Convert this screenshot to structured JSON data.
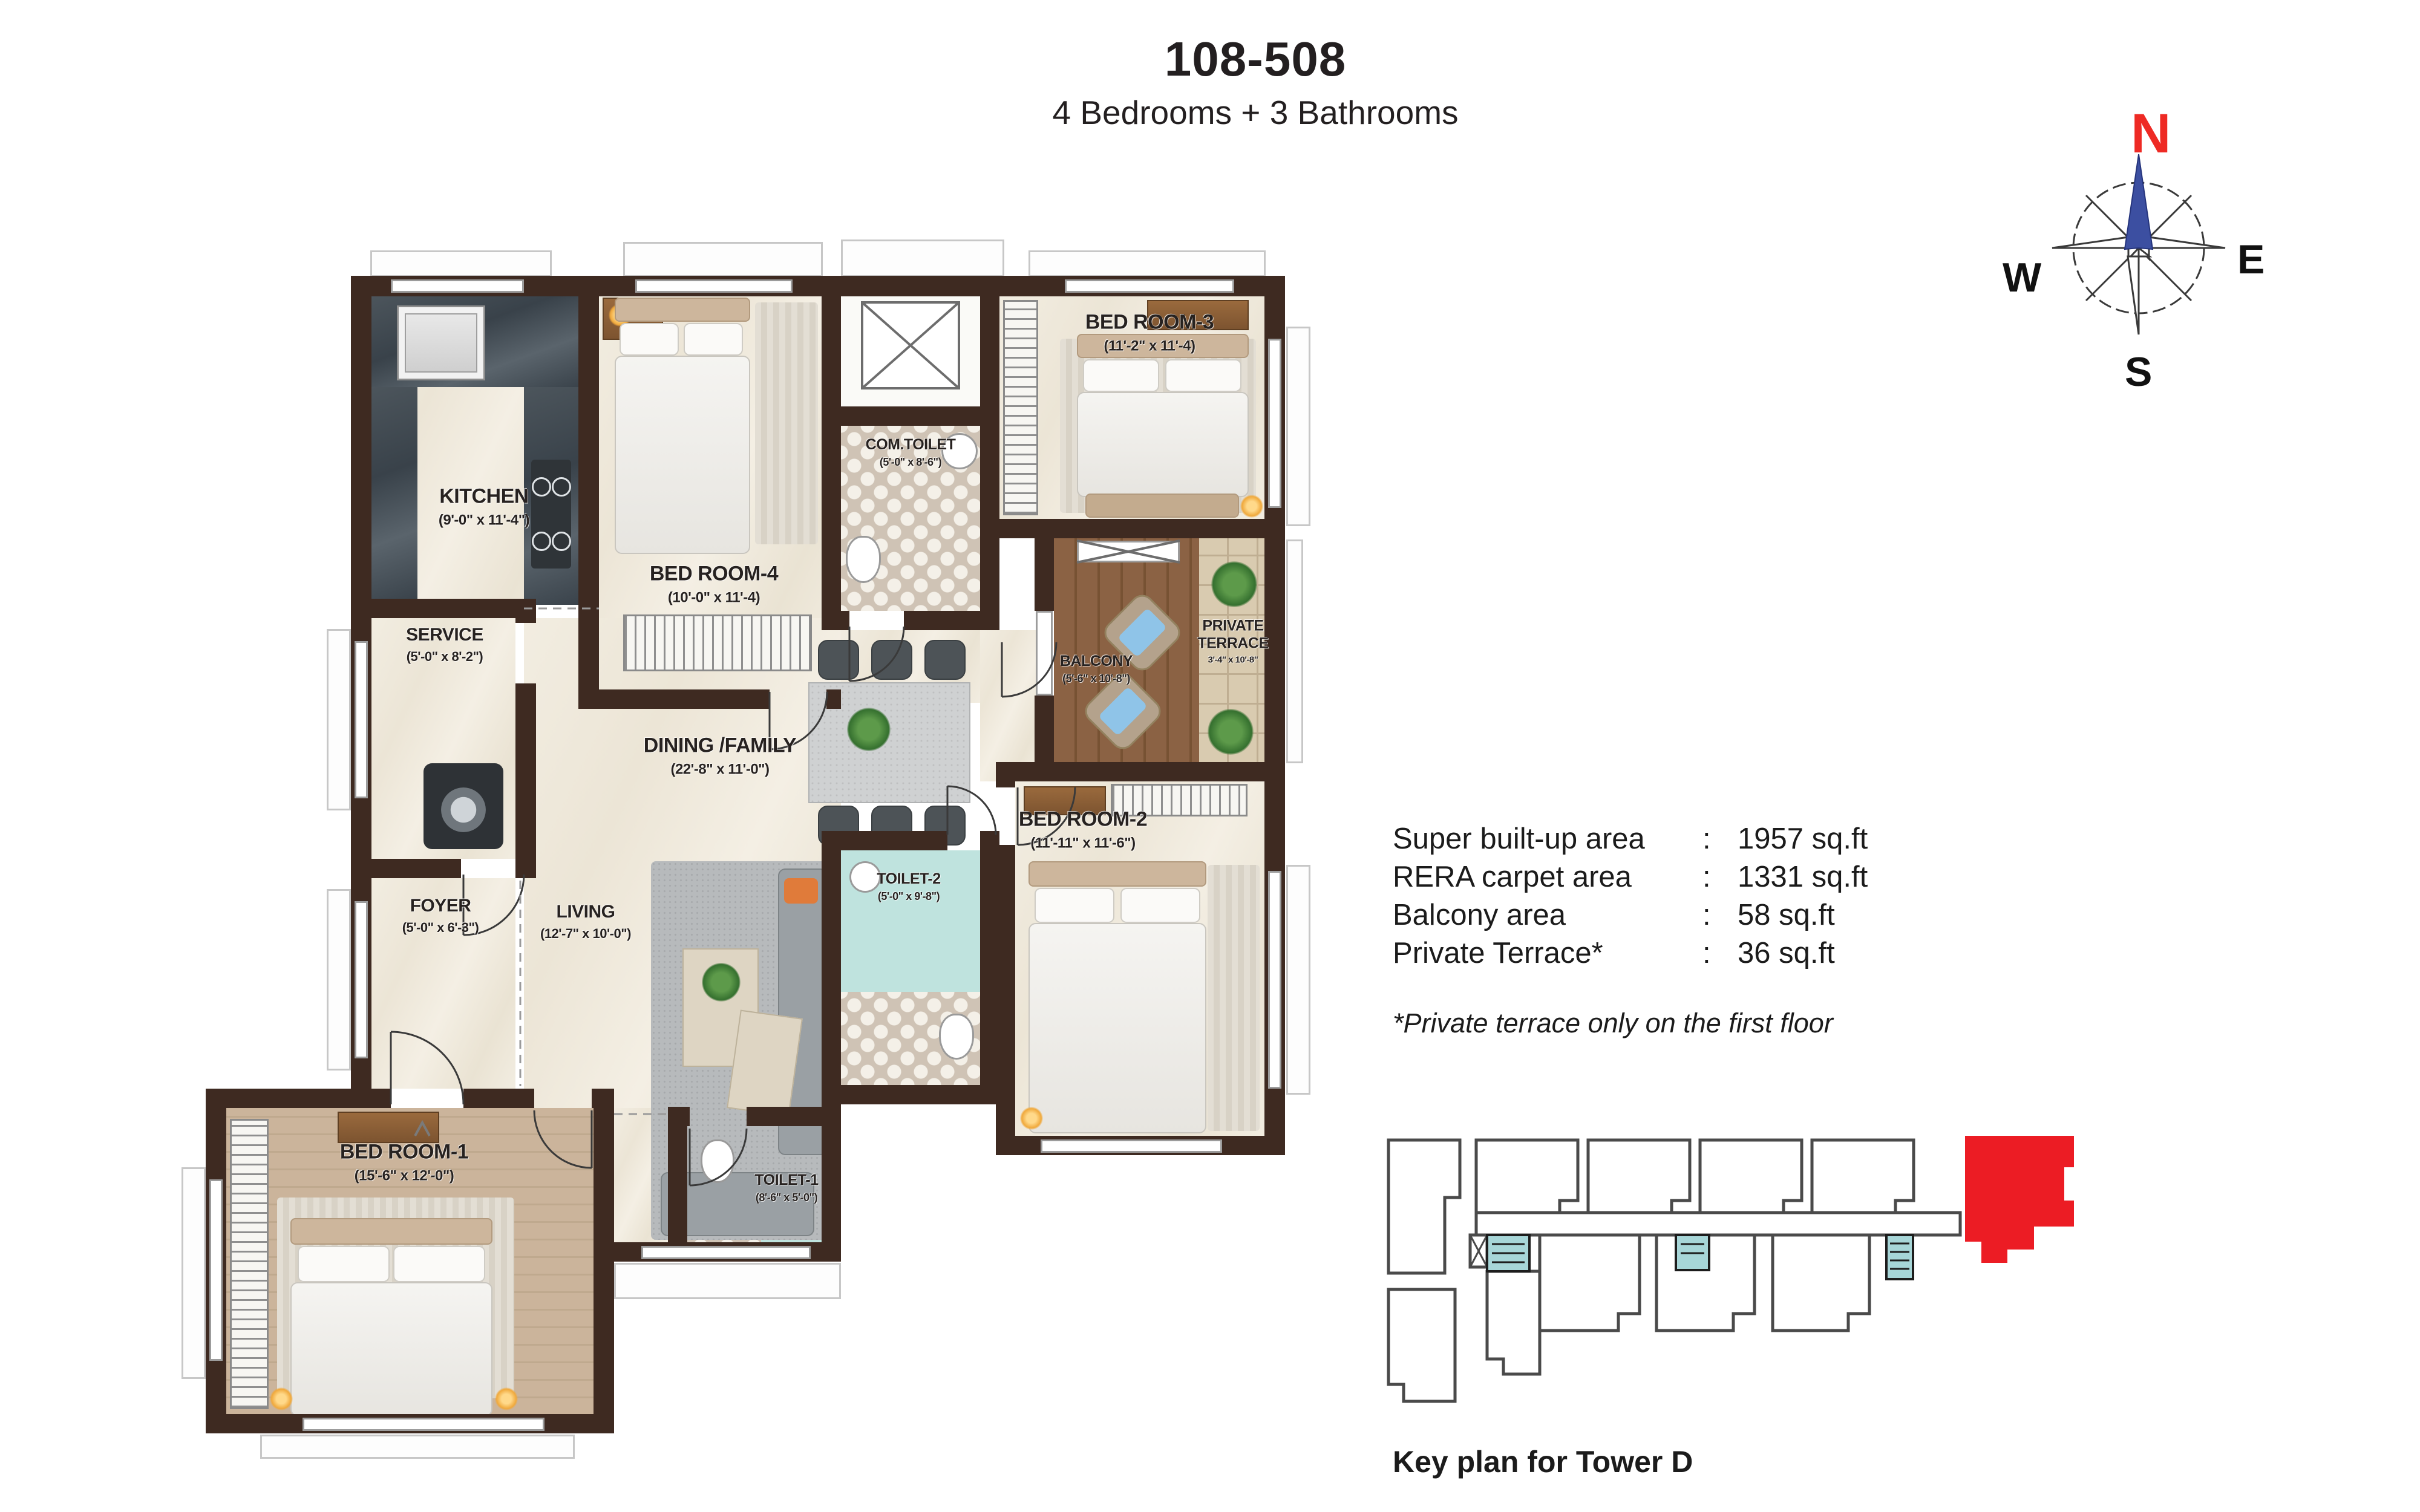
{
  "header": {
    "title": "108-508",
    "subtitle": "4 Bedrooms + 3 Bathrooms"
  },
  "compass": {
    "north": "N",
    "east": "E",
    "south": "S",
    "west": "W",
    "north_color": "#ee2a24",
    "needle_color": "#3c4fa1"
  },
  "rooms": {
    "kitchen": {
      "name": "KITCHEN",
      "dims": "(9'-0\" x 11'-4\")"
    },
    "bedroom4": {
      "name": "BED ROOM-4",
      "dims": "(10'-0\" x 11'-4)"
    },
    "comtoilet": {
      "name": "COM.TOILET",
      "dims": "(5'-0\" x 8'-6\")"
    },
    "bedroom3": {
      "name": "BED ROOM-3",
      "dims": "(11'-2\" x 11'-4)"
    },
    "service": {
      "name": "SERVICE",
      "dims": "(5'-0\" x 8'-2\")"
    },
    "foyer": {
      "name": "FOYER",
      "dims": "(5'-0\" x 6'-3\")"
    },
    "dining": {
      "name": "DINING /FAMILY",
      "dims": "(22'-8\" x 11'-0\")"
    },
    "balcony": {
      "name": "BALCONY",
      "dims": "(5'-6\" x 10'-8\")"
    },
    "terrace": {
      "name": "PRIVATE TERRACE",
      "dims": "3'-4\" x 10'-8\""
    },
    "living": {
      "name": "LIVING",
      "dims": "(12'-7\" x 10'-0\")"
    },
    "toilet2": {
      "name": "TOILET-2",
      "dims": "(5'-0\" x 9'-8\")"
    },
    "bedroom2": {
      "name": "BED ROOM-2",
      "dims": "(11'-11\" x 11'-6\")"
    },
    "bedroom1": {
      "name": "BED ROOM-1",
      "dims": "(15'-6\" x 12'-0\")"
    },
    "toilet1": {
      "name": "TOILET-1",
      "dims": "(8'-6\" x 5'-0\")"
    }
  },
  "areas": {
    "rows": [
      {
        "label": "Super built-up area",
        "colon": ":",
        "value": "1957 sq.ft"
      },
      {
        "label": "RERA carpet area",
        "colon": ":",
        "value": "1331 sq.ft"
      },
      {
        "label": "Balcony area",
        "colon": ":",
        "value": "58 sq.ft"
      },
      {
        "label": "Private Terrace*",
        "colon": ":",
        "value": "36 sq.ft"
      }
    ],
    "footnote": "*Private terrace only on the first floor"
  },
  "keyplan": {
    "caption": "Key plan for Tower D",
    "highlight_color": "#ec1c24",
    "core_color": "#a7d6d8",
    "wall_color": "#3e2a21"
  }
}
